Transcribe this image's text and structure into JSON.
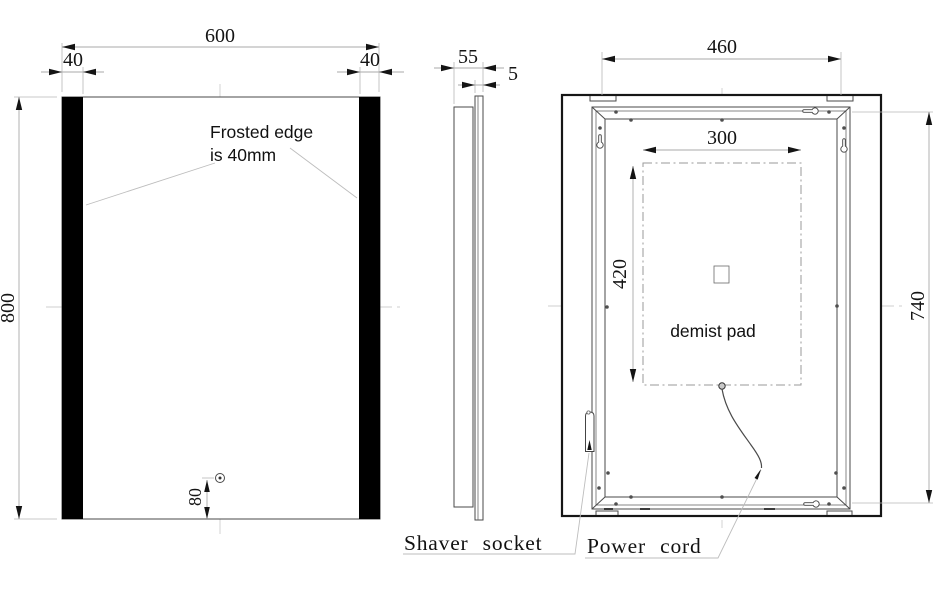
{
  "drawing": {
    "front_view": {
      "width_label": "600",
      "frost_left_label": "40",
      "frost_right_label": "40",
      "height_label": "800",
      "sensor_offset_label": "80",
      "note": {
        "line1": "Frosted edge",
        "line2": "is 40mm"
      }
    },
    "side_view": {
      "depth_label": "55",
      "glass_label": "5"
    },
    "back_view": {
      "width_label": "460",
      "height_label": "740",
      "pad_width_label": "300",
      "pad_height_label": "420",
      "pad_label": "demist pad",
      "socket_label": "Shaver socket",
      "cord_label": "Power cord"
    },
    "colors": {
      "frosted_band": "#000000",
      "outline": "#4a4a4a",
      "dimension": "#a9a9a9",
      "text": "#141414",
      "background": "#ffffff"
    }
  }
}
